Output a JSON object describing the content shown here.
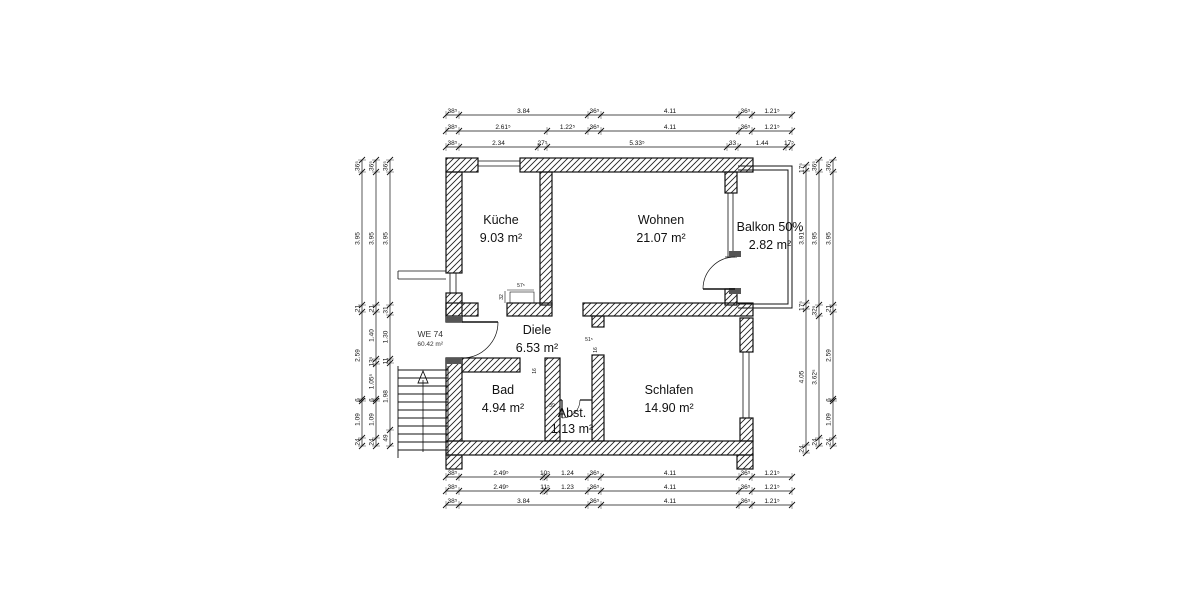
{
  "unit": {
    "id": "WE 74",
    "area": "60.42 m²"
  },
  "rooms": [
    {
      "name": "Küche",
      "area": "9.03 m²"
    },
    {
      "name": "Wohnen",
      "area": "21.07 m²"
    },
    {
      "name": "Balkon 50%",
      "area": "2.82 m²"
    },
    {
      "name": "Diele",
      "area": "6.53 m²"
    },
    {
      "name": "Bad",
      "area": "4.94 m²"
    },
    {
      "name": "Abst.",
      "area": "1.13 m²"
    },
    {
      "name": "Schlafen",
      "area": "14.90 m²"
    }
  ],
  "dims": {
    "top": [
      [
        "38⁵",
        "3.84",
        "36⁵",
        "4.11",
        "36⁵",
        "1.21⁵"
      ],
      [
        "38⁵",
        "2.61⁵",
        "1.22⁵",
        "36⁵",
        "4.11",
        "36⁵",
        "1.21⁵"
      ],
      [
        "38⁵",
        "2.34",
        "27⁵",
        "5.33⁵",
        "33",
        "1.44",
        "17⁵"
      ]
    ],
    "bottom": [
      [
        "38⁵",
        "2.49⁵",
        "10⁵",
        "1.24",
        "36⁵",
        "4.11",
        "36⁵",
        "1.21⁵"
      ],
      [
        "38⁵",
        "2.49⁵",
        "11⁵",
        "1.23",
        "36⁵",
        "4.11",
        "36⁵",
        "1.21⁵"
      ],
      [
        "38⁵",
        "3.84",
        "36⁵",
        "4.11",
        "36⁵",
        "1.21⁵"
      ]
    ],
    "left": [
      [
        "36⁵",
        "3.95",
        "21",
        "2.59",
        "6",
        "1.09",
        "24"
      ],
      [
        "36⁵",
        "3.95",
        "21",
        "1.40",
        "13⁵",
        "1.05⁵",
        "6",
        "1.09",
        "24"
      ],
      [
        "36⁵",
        "3.95",
        "31",
        "1.30",
        "11",
        "1.98",
        "49"
      ]
    ],
    "right": [
      [
        "17⁵",
        "3.91⁵",
        "17⁵",
        "4.05",
        "24"
      ],
      [
        "36⁵",
        "3.95",
        "32⁵",
        "3.62⁵",
        "24"
      ],
      [
        "36⁵",
        "3.95",
        "21",
        "2.59",
        "6",
        "1.09",
        "24"
      ]
    ],
    "micro": [
      "57⁵",
      "32",
      "16",
      "51⁵",
      "39",
      "16"
    ]
  }
}
